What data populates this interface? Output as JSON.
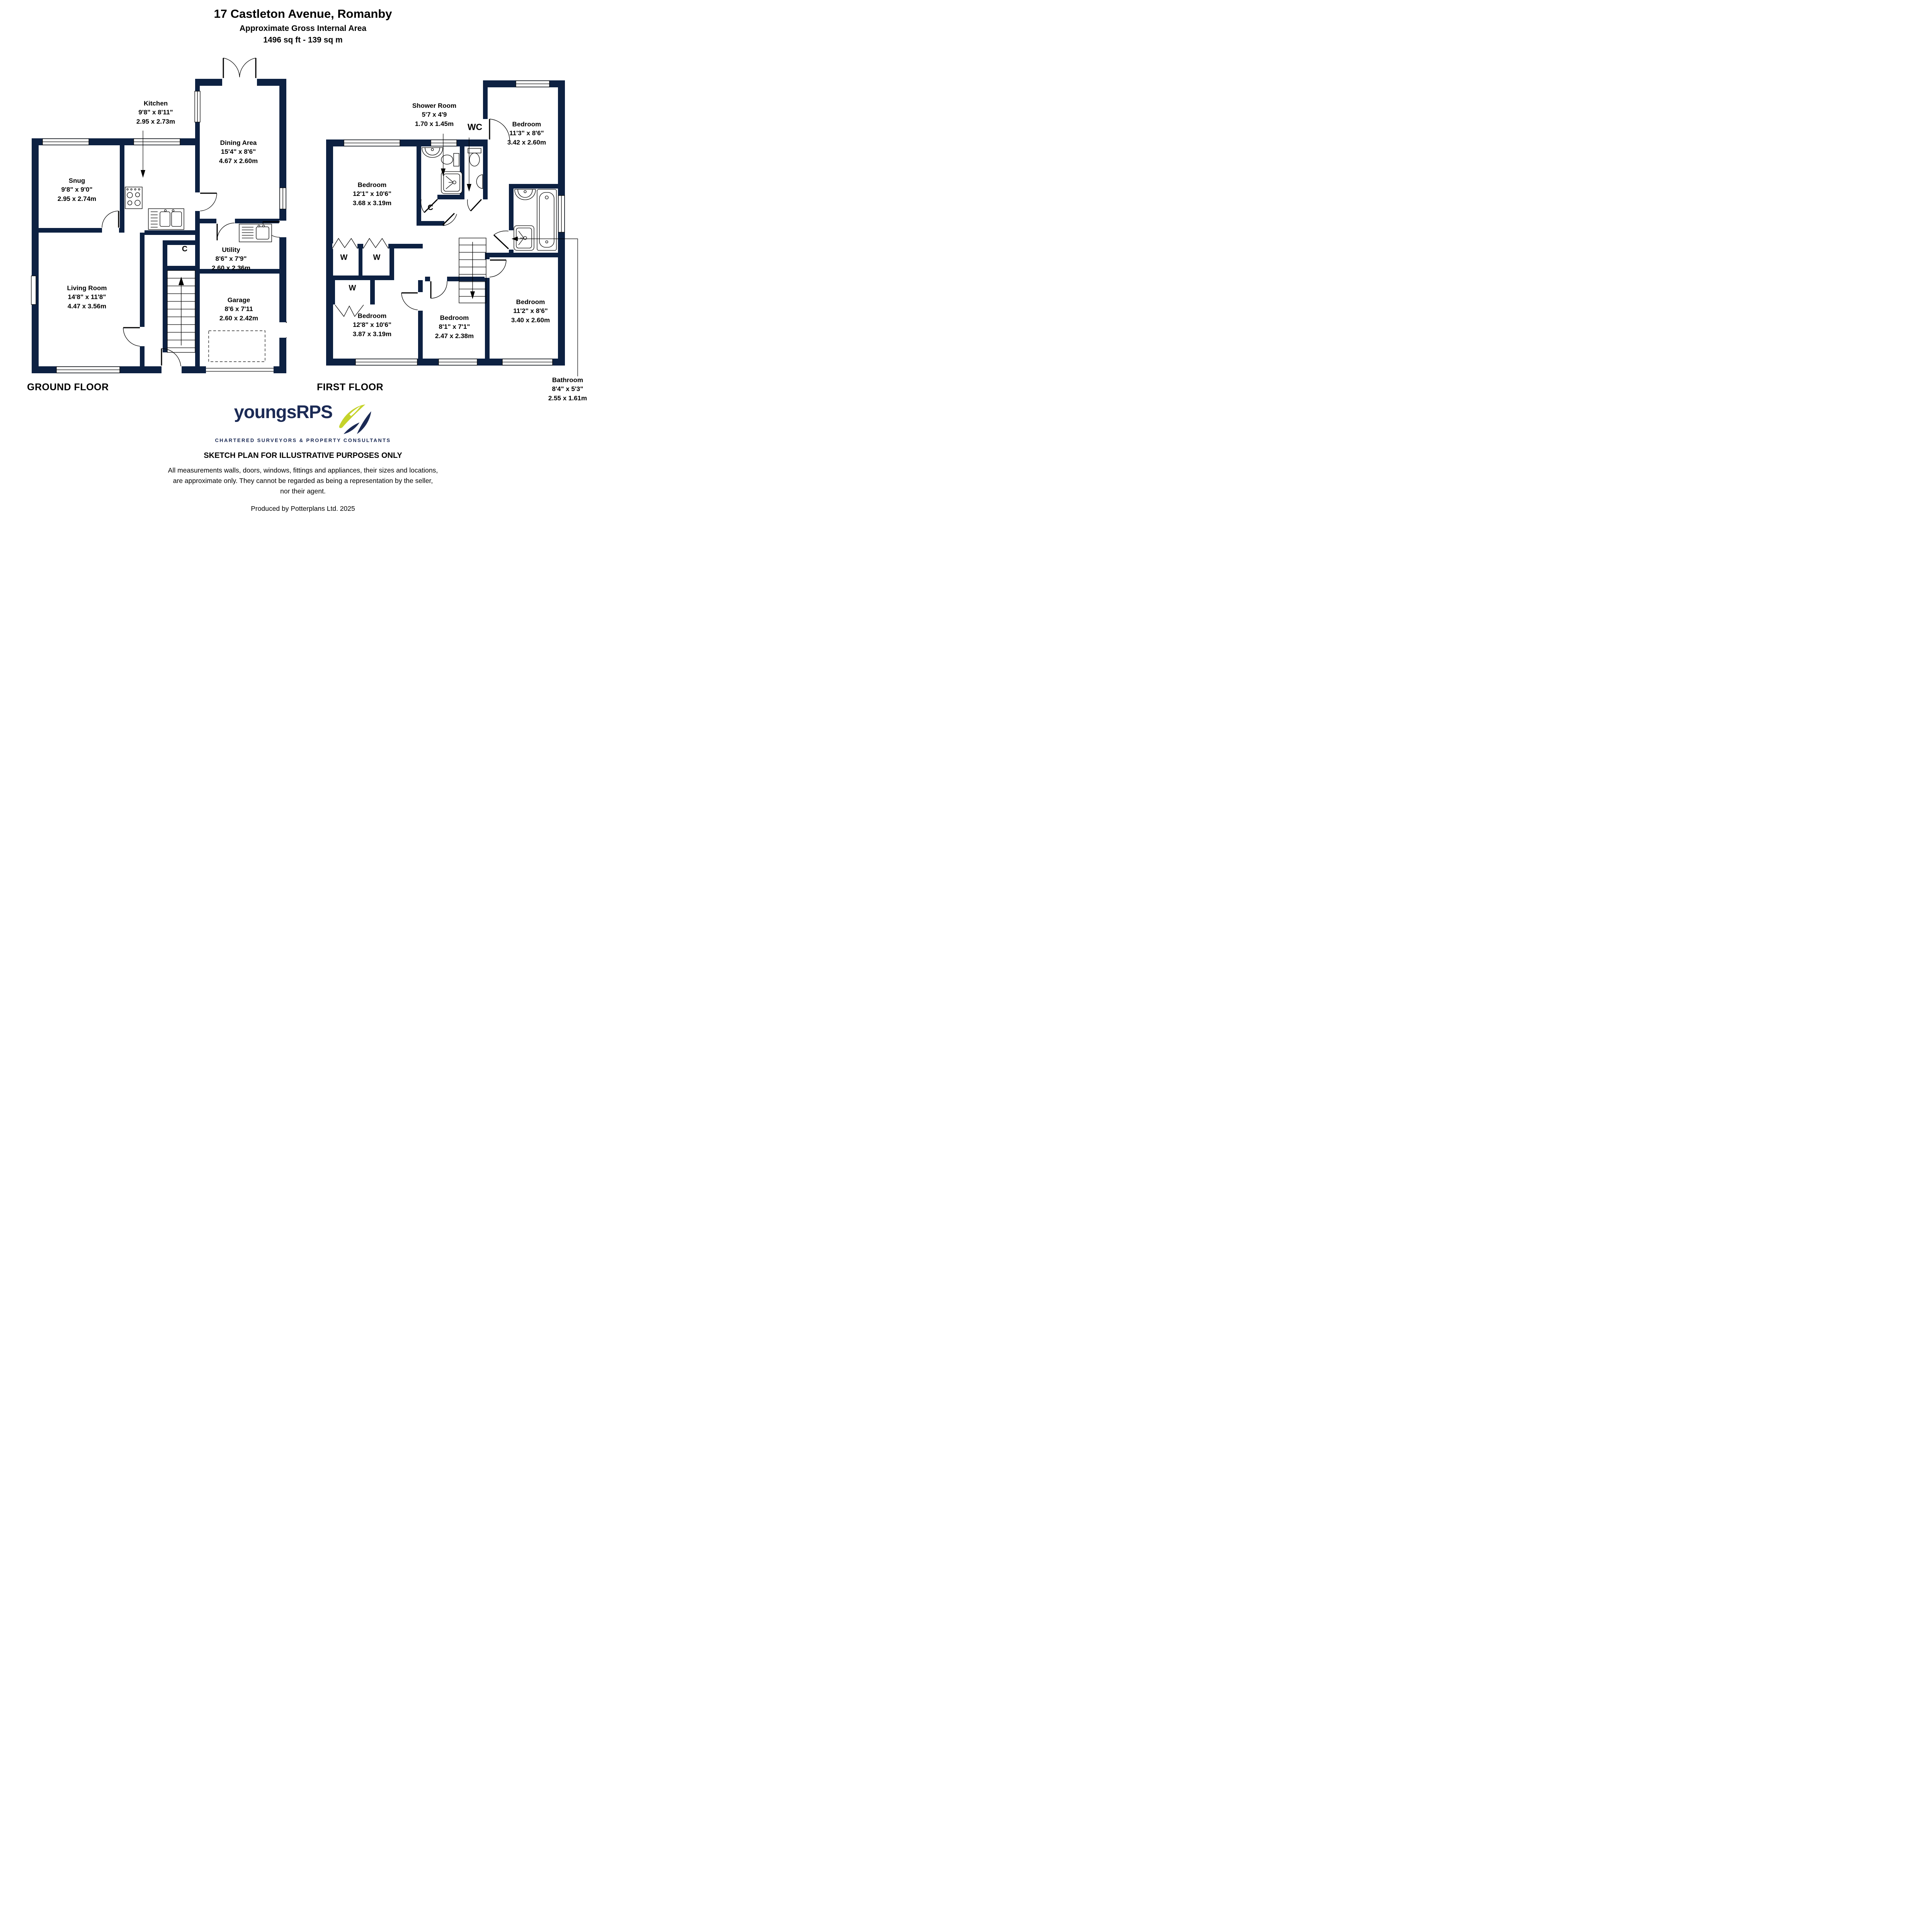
{
  "header": {
    "address": "17 Castleton Avenue, Romanby",
    "subtitle": "Approximate Gross Internal Area",
    "area": "1496 sq ft - 139 sq m"
  },
  "ground_floor": {
    "label": "GROUND FLOOR",
    "rooms": {
      "snug": {
        "name": "Snug",
        "imperial": "9'8\" x 9'0\"",
        "metric": "2.95 x 2.74m"
      },
      "kitchen": {
        "name": "Kitchen",
        "imperial": "9'8\" x 8'11\"",
        "metric": "2.95 x 2.73m"
      },
      "dining": {
        "name": "Dining Area",
        "imperial": "15'4\" x 8'6\"",
        "metric": "4.67 x 2.60m"
      },
      "living": {
        "name": "Living Room",
        "imperial": "14'8\" x 11'8\"",
        "metric": "4.47 x 3.56m"
      },
      "utility": {
        "name": "Utility",
        "imperial": "8'6\" x 7'9\"",
        "metric": "2.60 x 2.36m"
      },
      "garage": {
        "name": "Garage",
        "imperial": "8'6 x 7'11",
        "metric": "2.60 x 2.42m"
      },
      "cupboard": {
        "name": "C"
      }
    }
  },
  "first_floor": {
    "label": "FIRST FLOOR",
    "rooms": {
      "shower_room": {
        "name": "Shower Room",
        "imperial": "5'7 x 4'9",
        "metric": "1.70 x 1.45m"
      },
      "wc": {
        "name": "WC"
      },
      "bedroom_ne": {
        "name": "Bedroom",
        "imperial": "11'3\" x 8'6\"",
        "metric": "3.42 x 2.60m"
      },
      "bedroom_nw": {
        "name": "Bedroom",
        "imperial": "12'1\" x 10'6\"",
        "metric": "3.68 x 3.19m"
      },
      "bedroom_sw": {
        "name": "Bedroom",
        "imperial": "12'8\" x 10'6\"",
        "metric": "3.87 x 3.19m"
      },
      "bedroom_s": {
        "name": "Bedroom",
        "imperial": "8'1\" x 7'1\"",
        "metric": "2.47 x 2.38m"
      },
      "bedroom_se": {
        "name": "Bedroom",
        "imperial": "11'2\" x 8'6\"",
        "metric": "3.40 x 2.60m"
      },
      "bathroom": {
        "name": "Bathroom",
        "imperial": "8'4\" x 5'3\"",
        "metric": "2.55 x 1.61m"
      },
      "cupboard": {
        "name": "C"
      },
      "wardrobe": {
        "name": "W"
      }
    }
  },
  "branding": {
    "brand": "youngsRPS",
    "tagline": "CHARTERED SURVEYORS & PROPERTY CONSULTANTS",
    "logo_navy": "#1b2a55",
    "logo_green": "#c5d32a"
  },
  "footer": {
    "notice": "SKETCH PLAN FOR ILLUSTRATIVE PURPOSES ONLY",
    "disclaimer": "All measurements walls, doors, windows, fittings and appliances, their sizes and locations, are approximate only. They cannot be regarded as being a representation by the seller, nor their agent.",
    "produced_by": "Produced by Potterplans Ltd. 2025"
  },
  "colors": {
    "wall": "#0d2142",
    "line": "#000000",
    "background": "#ffffff"
  }
}
